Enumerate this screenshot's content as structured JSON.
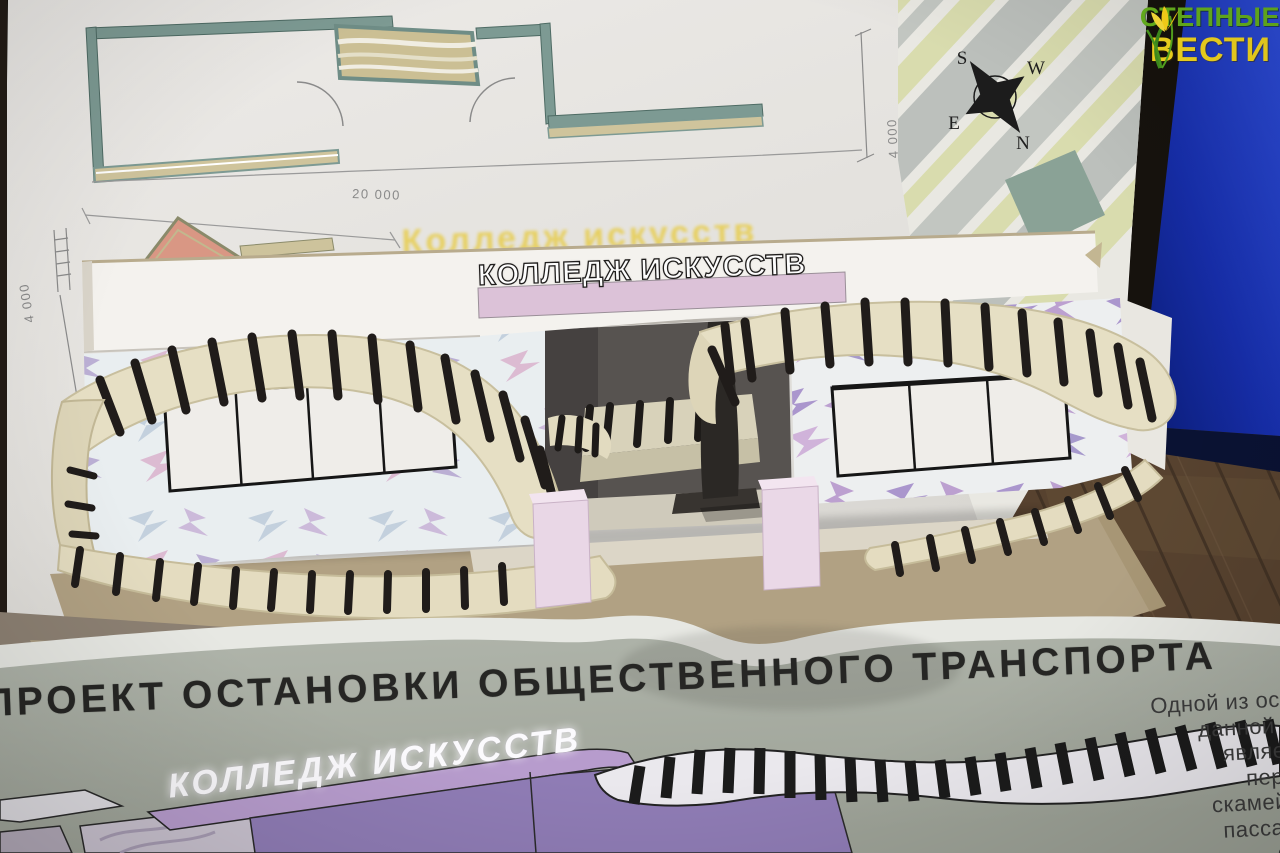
{
  "watermark": {
    "line1": "СТЕПНЫЕ",
    "line2": "ВЕСТИ",
    "line1_color": "#68b41e",
    "line2_color": "#f5d81f",
    "icon": "tulip-sprout-icon"
  },
  "blueprint": {
    "title": "Колледж искусств",
    "dim_width": "20 000",
    "dim_height": "4 000",
    "compass": {
      "s": "S",
      "w": "W",
      "e": "E",
      "n": "N"
    }
  },
  "model": {
    "sign_text": "КОЛЛЕДЖ ИСКУССТВ",
    "sign_strip_color": "#dcc2d8"
  },
  "poster": {
    "title": "ПРОЕКТ ОСТАНОВКИ ОБЩЕСТВЕННОГО ТРАНСПОРТА",
    "subtitle": "КОЛЛЕДЖ ИСКУССТВ",
    "paragraph_lines": [
      "Одной из осо",
      "данной о",
      "являет",
      "пере",
      "скамейк",
      "пассаж",
      "от"
    ],
    "accent_purple": "#8f7cb5"
  }
}
